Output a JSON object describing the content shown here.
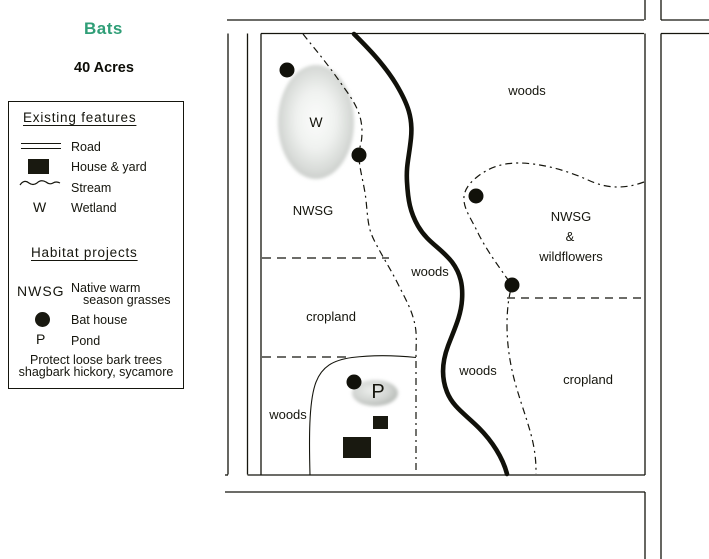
{
  "title": "Bats",
  "subtitle": "40 Acres",
  "colors": {
    "title_green": "#2f9e77",
    "ink": "#15150d",
    "wetland_gray": "#c7cac7",
    "pond_gray": "#b2b6b2"
  },
  "legend": {
    "existing_title": "Existing features",
    "existing": [
      {
        "symbol": "road-lines-icon",
        "label": "Road"
      },
      {
        "symbol": "house-square-icon",
        "label": "House & yard"
      },
      {
        "symbol": "stream-squiggle-icon",
        "label": "Stream"
      },
      {
        "symbol": "W",
        "label": "Wetland"
      }
    ],
    "habitat_title": "Habitat projects",
    "habitat": [
      {
        "symbol": "NWSG",
        "label": "Native warm",
        "label2": "season grasses"
      },
      {
        "symbol": "bat-house-dot-icon",
        "label": "Bat house"
      },
      {
        "symbol": "P",
        "label": "Pond"
      }
    ],
    "note_line1": "Protect loose bark trees",
    "note_line2": "shagbark hickory, sycamore"
  },
  "map_labels": [
    {
      "text": "woods"
    },
    {
      "text": "W"
    },
    {
      "text": "NWSG"
    },
    {
      "text": "NWSG"
    },
    {
      "text": "&"
    },
    {
      "text": "wildflowers"
    },
    {
      "text": "woods"
    },
    {
      "text": "cropland"
    },
    {
      "text": "woods"
    },
    {
      "text": "cropland"
    },
    {
      "text": "woods"
    },
    {
      "text": "P"
    }
  ]
}
